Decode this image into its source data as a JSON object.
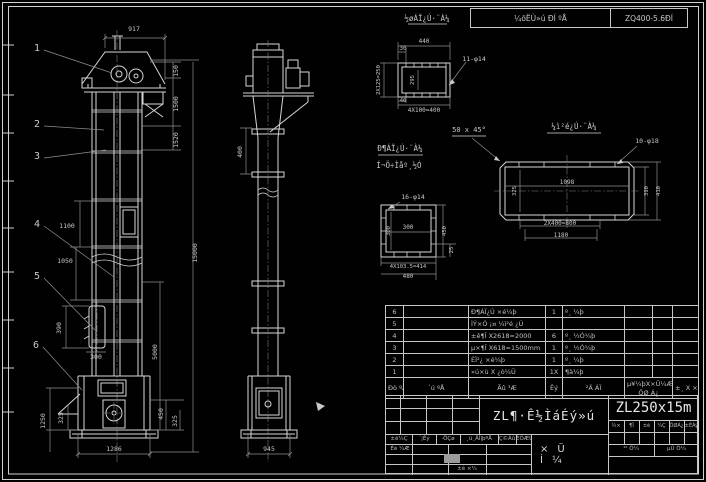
{
  "top_bar": {
    "left": "¼õËÙ»ú ÐÍ ºÅ",
    "right": "ZQ400-5.6ÐÍ"
  },
  "callouts": [
    {
      "t": "1",
      "x": 37,
      "y": 51
    },
    {
      "t": "2",
      "x": 37,
      "y": 127
    },
    {
      "t": "3",
      "x": 37,
      "y": 159
    },
    {
      "t": "4",
      "x": 37,
      "y": 227
    },
    {
      "t": "5",
      "x": 37,
      "y": 279
    },
    {
      "t": "6",
      "x": 36,
      "y": 348
    }
  ],
  "annotations": [
    {
      "n": "dim-top-width",
      "t": "917",
      "x": 134,
      "y": 31
    },
    {
      "n": "dim-head-150",
      "t": "150",
      "x": 178,
      "y": 71,
      "r": -90
    },
    {
      "n": "dim-upper-1500",
      "t": "1500",
      "x": 178,
      "y": 104,
      "r": -90
    },
    {
      "n": "dim-upper-1520",
      "t": "1520",
      "x": 178,
      "y": 140,
      "r": -90
    },
    {
      "n": "dim-overall-15000",
      "t": "15000",
      "x": 197,
      "y": 253,
      "r": -90
    },
    {
      "n": "dim-lower-5000",
      "t": "5000",
      "x": 157,
      "y": 352,
      "r": -90
    },
    {
      "n": "dim-section-1100",
      "t": "1100",
      "x": 67,
      "y": 228
    },
    {
      "n": "dim-section-1050",
      "t": "1050",
      "x": 65,
      "y": 263
    },
    {
      "n": "dim-window-390",
      "t": "390",
      "x": 61,
      "y": 328,
      "r": -90
    },
    {
      "n": "dim-window-300",
      "t": "300",
      "x": 96,
      "y": 359
    },
    {
      "n": "dim-boot-1250",
      "t": "1250",
      "x": 45,
      "y": 421,
      "r": -90
    },
    {
      "n": "dim-boot-325",
      "t": "325",
      "x": 63,
      "y": 418,
      "r": -90
    },
    {
      "n": "dim-boot-450",
      "t": "450",
      "x": 163,
      "y": 414,
      "r": -90
    },
    {
      "n": "dim-boot-325b",
      "t": "325",
      "x": 177,
      "y": 421,
      "r": -90
    },
    {
      "n": "dim-boot-width",
      "t": "1286",
      "x": 114,
      "y": 451
    },
    {
      "n": "dim-side-400",
      "t": "400",
      "x": 242,
      "y": 152,
      "r": -90
    },
    {
      "n": "dim-side-width",
      "t": "945",
      "x": 269,
      "y": 451
    },
    {
      "n": "inlet-title",
      "t": "½øÁÏ¿Ú·¨À¼",
      "x": 427,
      "y": 21,
      "s": 7.5
    },
    {
      "n": "inlet-dim-440",
      "t": "440",
      "x": 424,
      "y": 43,
      "s": 6
    },
    {
      "n": "inlet-dim-30",
      "t": "30",
      "x": 403,
      "y": 50,
      "s": 6
    },
    {
      "n": "inlet-dim-250",
      "t": "2X125=250",
      "x": 380,
      "y": 80,
      "r": -90,
      "s": 5.5
    },
    {
      "n": "inlet-dim-295",
      "t": "295",
      "x": 414,
      "y": 80,
      "r": -90,
      "s": 5.5
    },
    {
      "n": "inlet-dim-40",
      "t": "40",
      "x": 403,
      "y": 102,
      "s": 5.5
    },
    {
      "n": "inlet-dim-400",
      "t": "4X100=400",
      "x": 424,
      "y": 112,
      "s": 6
    },
    {
      "n": "inlet-holes-note",
      "t": "11-φ14",
      "x": 474,
      "y": 61,
      "s": 6.5
    },
    {
      "n": "chamfer-note",
      "t": "50 x 45°",
      "x": 469,
      "y": 132,
      "s": 7
    },
    {
      "n": "outlet-title-1",
      "t": "Ð¶ÁÏ¿Ú·¨À¼",
      "x": 400,
      "y": 151,
      "s": 7.5
    },
    {
      "n": "outlet-title-2",
      "t": "Í¬Ö÷Ìåº¸½Ó",
      "x": 399,
      "y": 168,
      "s": 7.5
    },
    {
      "n": "outlet-holes-note",
      "t": "16-φ14",
      "x": 413,
      "y": 199,
      "s": 6.5
    },
    {
      "n": "outlet-dim-300h",
      "t": "300",
      "x": 408,
      "y": 229,
      "s": 6
    },
    {
      "n": "outlet-dim-300v",
      "t": "300",
      "x": 390,
      "y": 231,
      "r": -90,
      "s": 5.5
    },
    {
      "n": "outlet-dim-450",
      "t": "450",
      "x": 446,
      "y": 231,
      "r": -90,
      "s": 5.5
    },
    {
      "n": "outlet-dim-25",
      "t": "25",
      "x": 453,
      "y": 250,
      "r": -90,
      "s": 5.5
    },
    {
      "n": "outlet-dim-414",
      "t": "4X103.5=414",
      "x": 408,
      "y": 268,
      "s": 5.5
    },
    {
      "n": "outlet-dim-480",
      "t": "480",
      "x": 408,
      "y": 278,
      "s": 6
    },
    {
      "n": "plate-title",
      "t": "¼ì²é¿Ú·¨À¼",
      "x": 574,
      "y": 129,
      "s": 7.5
    },
    {
      "n": "plate-holes-note",
      "t": "10-φ18",
      "x": 647,
      "y": 143,
      "s": 6.5
    },
    {
      "n": "plate-dim-1098",
      "t": "1098",
      "x": 567,
      "y": 184,
      "s": 6
    },
    {
      "n": "plate-dim-325",
      "t": "325",
      "x": 516,
      "y": 191,
      "r": -90,
      "s": 5.5
    },
    {
      "n": "plate-dim-390",
      "t": "390",
      "x": 648,
      "y": 191,
      "r": -90,
      "s": 5.5
    },
    {
      "n": "plate-dim-410",
      "t": "410",
      "x": 660,
      "y": 191,
      "r": -90,
      "s": 5.5
    },
    {
      "n": "plate-dim-800",
      "t": "2X400=800",
      "x": 560,
      "y": 225,
      "s": 6
    },
    {
      "n": "plate-dim-1180",
      "t": "1180",
      "x": 561,
      "y": 237,
      "s": 6
    }
  ],
  "parts_table": {
    "headers": {
      "no": "Ðò ºÅ",
      "code": "´ú  ºÅ",
      "name": "Ãû  ³Æ",
      "qty": "Êý",
      "mat": "²Ä  ÁÏ",
      "w_top": "µ¥¼þX×Ü¼Æ",
      "w_bot": "ÖØ Á¿",
      "note": "±¸ X ×¢"
    },
    "rows": [
      {
        "no": "6",
        "code": "",
        "name": "Ð¶ÁÏ¿Ú ×é¼þ",
        "qty": "1",
        "mat": "º¸ ¼þ",
        "w1": "",
        "w2": "",
        "note": ""
      },
      {
        "no": "5",
        "code": "",
        "name": "ÌÝ×Ó ¡¤ ¼ì²é ¿Ú",
        "qty": "",
        "mat": "",
        "w1": "",
        "w2": "",
        "note": ""
      },
      {
        "no": "4",
        "code": "",
        "name": "±ê¶Î X2618=2000",
        "qty": "6",
        "mat": "º¸ ½Ó¼þ",
        "w1": "",
        "w2": "",
        "note": ""
      },
      {
        "no": "3",
        "code": "",
        "name": "µ×¶Î X618=1500mm",
        "qty": "1",
        "mat": "º¸ ½Ó¼þ",
        "w1": "",
        "w2": "",
        "note": ""
      },
      {
        "no": "2",
        "code": "",
        "name": "ÉÏ²¿ ×é¼þ",
        "qty": "1",
        "mat": "º¸ ¼þ",
        "w1": "",
        "w2": "",
        "note": ""
      },
      {
        "no": "1",
        "code": "",
        "name": "»ú×ù X ¿ò¼Ü",
        "qty": "1X",
        "mat": "¶à¼þ",
        "w1": "",
        "w2": "",
        "note": ""
      }
    ]
  },
  "title_block": {
    "model": "ZL250x15m",
    "product": "ZL¶·Ê½ÌáÉý»ú",
    "type": "×Ü Í¼",
    "strip": [
      "±ê¼Ç",
      "´¦Êý",
      "·ÖÇø",
      "¸ü¸ÄÎļþºÅ",
      "Ç©Ãû",
      "ÈÕÆÚ"
    ],
    "sign": "Éè ¼Æ",
    "approve": "±ê ×¼",
    "tiny": [
      "½×",
      "¶Î",
      "±ê",
      "¼Ç",
      "ÖØÁ¿",
      "±ÈÀý"
    ],
    "sheet": [
      "¹²  Õ¼",
      "µÚ  Õ¼"
    ]
  },
  "colors": {
    "line": "#d6d6d6",
    "dim": "#8f8f8f",
    "text": "#c8c8c8",
    "bg": "#000000"
  }
}
